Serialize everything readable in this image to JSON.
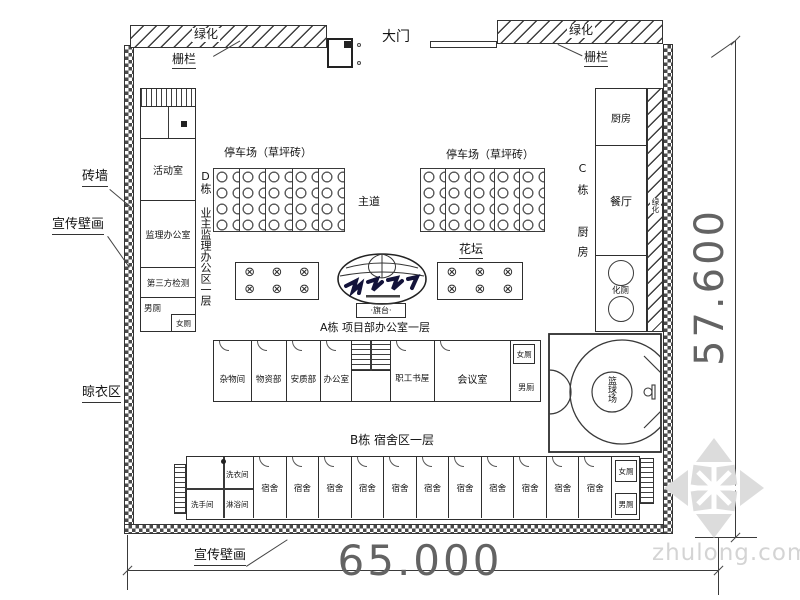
{
  "top": {
    "green_left": "绿化",
    "fence_left": "栅栏",
    "gate": "大门",
    "green_right": "绿化",
    "fence_right": "栅栏"
  },
  "side_labels": {
    "brick_wall": "砖墙",
    "mural_left": "宣传壁画",
    "drying_area": "晾衣区",
    "mural_bottom": "宣传壁画"
  },
  "dimensions": {
    "bottom": "65.000",
    "right": "57.600"
  },
  "d_building": {
    "vertical_label": "D栋 业主监理办公区一层",
    "rooms": {
      "activity": "活动室",
      "supervision": "监理办公室",
      "third_party": "第三方检测",
      "male_wc": "男厕",
      "female_wc": "女厕"
    }
  },
  "parking": {
    "left_label": "停车场（草坪砖）",
    "right_label": "停车场（草坪砖）",
    "main_road": "主道"
  },
  "plaza": {
    "flower_bed": "花坛",
    "flag_stand": "·旗台·",
    "plant_symbol": "⊗"
  },
  "a_building": {
    "label": "A栋 项目部办公室一层",
    "rooms": [
      "杂物间",
      "物资部",
      "安质部",
      "办公室",
      "职工书屋",
      "会议室"
    ],
    "female_wc": "女厕",
    "male_wc": "男厕"
  },
  "c_building": {
    "vertical_label": "C栋 厨房",
    "kitchen": "厨房",
    "dining": "餐厅",
    "septic": "化厕",
    "green_strip": "绿化"
  },
  "basketball": {
    "label": "篮球场"
  },
  "b_building": {
    "label": "B栋 宿舍区一层",
    "laundry": "洗衣间",
    "washroom": "洗手间",
    "shower": "淋浴间",
    "dorm_rooms": [
      "宿舍",
      "宿舍",
      "宿舍",
      "宿舍",
      "宿舍",
      "宿舍",
      "宿舍",
      "宿舍",
      "宿舍",
      "宿舍",
      "宿舍"
    ],
    "female_wc": "女厕",
    "male_wc": "男厕"
  },
  "watermark": {
    "text": "zhulong.com"
  }
}
